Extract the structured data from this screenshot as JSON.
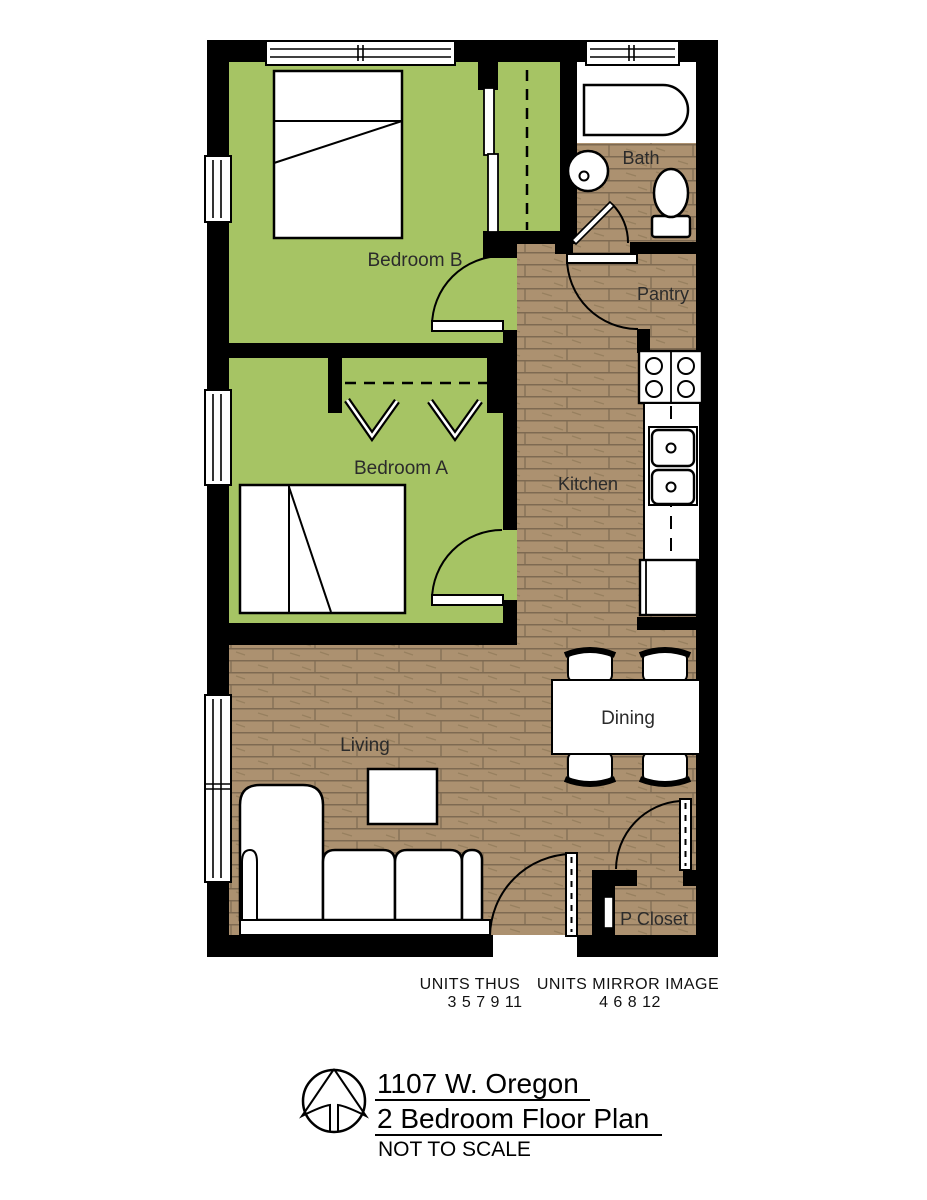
{
  "colors": {
    "bedroom_floor": "#a6c464",
    "wood_floor": "#ac9170",
    "wood_line": "#7e6a52",
    "wall": "#000000",
    "fixture": "#ffffff"
  },
  "labels": {
    "bedroom_b": "Bedroom B",
    "bedroom_a": "Bedroom A",
    "bath": "Bath",
    "pantry": "Pantry",
    "kitchen": "Kitchen",
    "living": "Living",
    "dining": "Dining",
    "p_closet": "P Closet"
  },
  "annotations": {
    "units_thus": "UNITS THUS",
    "units_thus_numbers": "3 5 7 9 11",
    "units_mirror": "UNITS MIRROR IMAGE",
    "units_mirror_numbers": "4 6 8 12"
  },
  "title": {
    "address": "1107 W. Oregon",
    "plan_name": "2 Bedroom Floor Plan",
    "scale_note": "NOT TO SCALE"
  }
}
